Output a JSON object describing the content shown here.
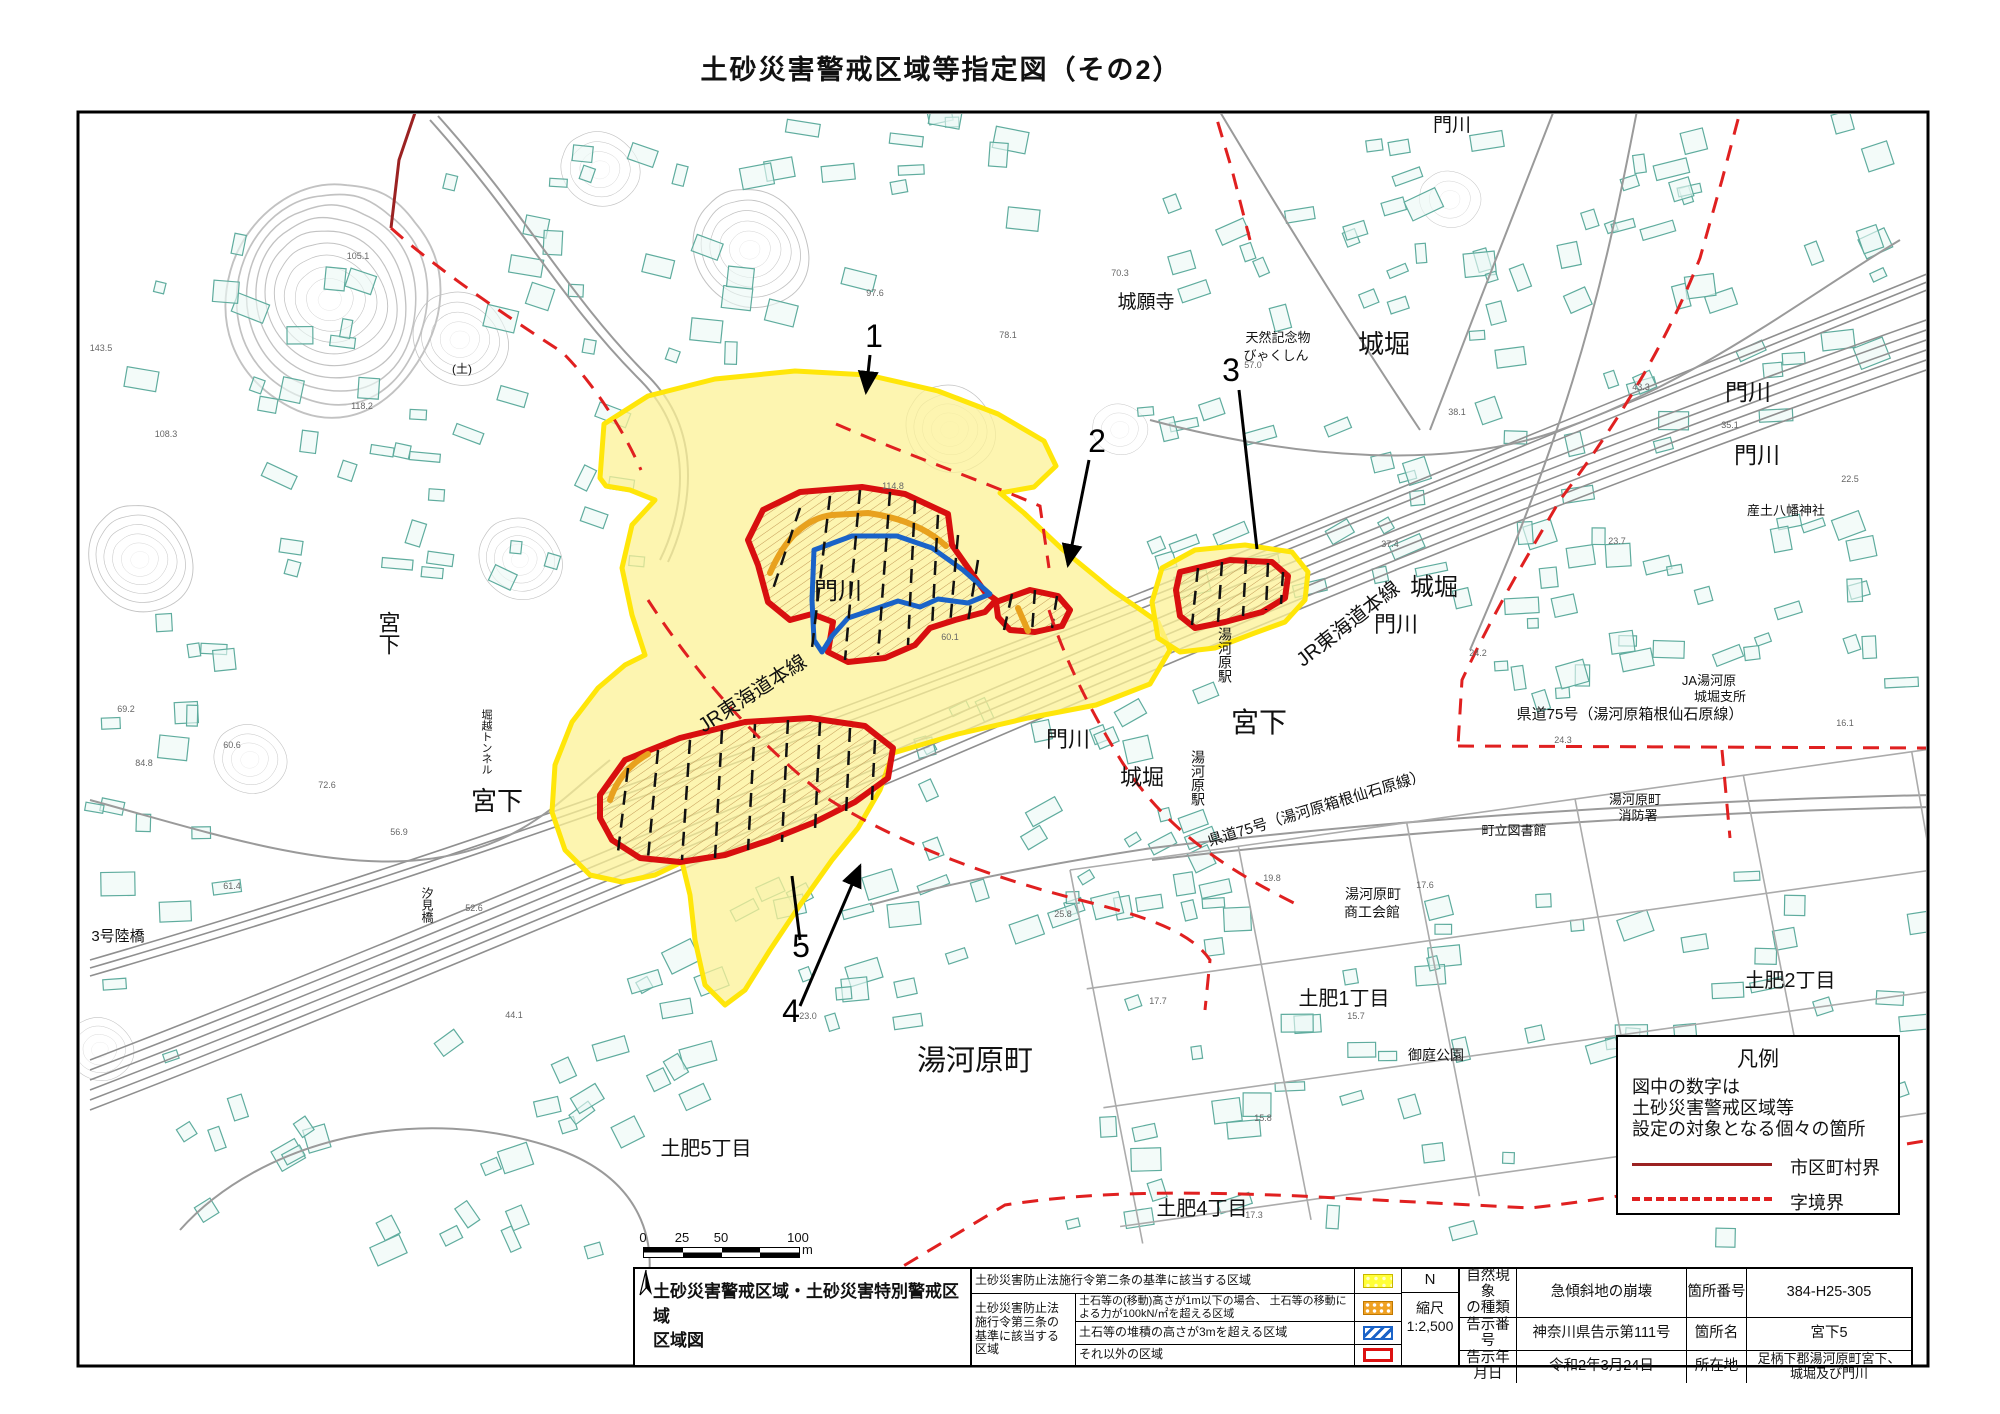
{
  "title": "土砂災害警戒区域等指定図（その2）",
  "map": {
    "place_labels": [
      {
        "t": "城堀",
        "x": 1464,
        "y": 70,
        "s": 19
      },
      {
        "t": "城堀",
        "x": 1524,
        "y": 108,
        "s": 19
      },
      {
        "t": "門川",
        "x": 1452,
        "y": 131,
        "s": 19
      },
      {
        "t": "門川",
        "x": 1748,
        "y": 400,
        "s": 23
      },
      {
        "t": "門川",
        "x": 1757,
        "y": 463,
        "s": 23
      },
      {
        "t": "城堀",
        "x": 1384,
        "y": 353,
        "s": 26
      },
      {
        "t": "城堀",
        "x": 1434,
        "y": 595,
        "s": 24
      },
      {
        "t": "城堀",
        "x": 1142,
        "y": 785,
        "s": 22
      },
      {
        "t": "門川",
        "x": 838,
        "y": 599,
        "s": 24
      },
      {
        "t": "門川",
        "x": 1068,
        "y": 747,
        "s": 22
      },
      {
        "t": "門川",
        "x": 1396,
        "y": 632,
        "s": 22
      },
      {
        "t": "城願寺",
        "x": 1146,
        "y": 308,
        "s": 19
      },
      {
        "t": "天然記念物",
        "x": 1278,
        "y": 342,
        "s": 13
      },
      {
        "t": "びゃくしん",
        "x": 1276,
        "y": 360,
        "s": 13
      },
      {
        "t": "宮下",
        "x": 1259,
        "y": 732,
        "s": 28
      },
      {
        "t": "宮下",
        "x": 497,
        "y": 810,
        "s": 26
      },
      {
        "t": "宮下",
        "x": 388,
        "y": 633,
        "s": 22,
        "v": 1
      },
      {
        "t": "湯河原町",
        "x": 975,
        "y": 1070,
        "s": 29
      },
      {
        "t": "土肥1丁目",
        "x": 1344,
        "y": 1005,
        "s": 20
      },
      {
        "t": "土肥2丁目",
        "x": 1790,
        "y": 987,
        "s": 20
      },
      {
        "t": "土肥5丁目",
        "x": 706,
        "y": 1155,
        "s": 20
      },
      {
        "t": "土肥4丁目",
        "x": 1202,
        "y": 1215,
        "s": 20
      },
      {
        "t": "御庭公園",
        "x": 1436,
        "y": 1060,
        "s": 14
      },
      {
        "t": "湯河原駅",
        "x": 1225,
        "y": 655,
        "s": 14,
        "v": 1
      },
      {
        "t": "湯河原駅",
        "x": 1198,
        "y": 778,
        "s": 14,
        "v": 1
      },
      {
        "t": "JR東海道本線",
        "x": 756,
        "y": 699,
        "s": 20,
        "r": -33
      },
      {
        "t": "JR東海道本線",
        "x": 1352,
        "y": 629,
        "s": 20,
        "r": -38
      },
      {
        "t": "県道75号（湯河原箱根仙石原線）",
        "x": 1318,
        "y": 813,
        "s": 15,
        "r": -17
      },
      {
        "t": "県道75号（湯河原箱根仙石原線）",
        "x": 1630,
        "y": 719,
        "s": 15
      },
      {
        "t": "JA湯河原",
        "x": 1709,
        "y": 685,
        "s": 13
      },
      {
        "t": "城堀支所",
        "x": 1720,
        "y": 701,
        "s": 13
      },
      {
        "t": "湯河原町",
        "x": 1635,
        "y": 804,
        "s": 13
      },
      {
        "t": "消防署",
        "x": 1638,
        "y": 820,
        "s": 13
      },
      {
        "t": "町立図書館",
        "x": 1514,
        "y": 835,
        "s": 13
      },
      {
        "t": "湯河原町",
        "x": 1373,
        "y": 899,
        "s": 14
      },
      {
        "t": "商工会館",
        "x": 1372,
        "y": 917,
        "s": 14
      },
      {
        "t": "産土八幡神社",
        "x": 1786,
        "y": 515,
        "s": 13
      },
      {
        "t": "3号陸橋",
        "x": 118,
        "y": 941,
        "s": 15
      },
      {
        "t": "汐見橋",
        "x": 427,
        "y": 905,
        "s": 12,
        "v": 1
      },
      {
        "t": "堀越トンネル",
        "x": 486,
        "y": 742,
        "s": 11,
        "v": 1
      },
      {
        "t": "(土)",
        "x": 462,
        "y": 373,
        "s": 12
      }
    ],
    "area_numbers": [
      {
        "n": "1",
        "x": 874,
        "y": 347,
        "x1": 870,
        "y1": 355,
        "x2": 866,
        "y2": 392,
        "a": 1
      },
      {
        "n": "2",
        "x": 1097,
        "y": 452,
        "x1": 1089,
        "y1": 460,
        "x2": 1068,
        "y2": 565,
        "a": 1
      },
      {
        "n": "3",
        "x": 1231,
        "y": 381,
        "x1": 1239,
        "y1": 390,
        "x2": 1257,
        "y2": 549,
        "a": 0
      },
      {
        "n": "4",
        "x": 791,
        "y": 1022,
        "x1": 800,
        "y1": 1006,
        "x2": 860,
        "y2": 866,
        "a": 1
      },
      {
        "n": "5",
        "x": 801,
        "y": 957,
        "x1": 800,
        "y1": 940,
        "x2": 792,
        "y2": 876,
        "a": 0
      }
    ],
    "spot_elevations": [
      {
        "v": "114.8",
        "x": 893,
        "y": 489
      },
      {
        "v": "60.1",
        "x": 950,
        "y": 640
      },
      {
        "v": "97.6",
        "x": 875,
        "y": 296
      },
      {
        "v": "78.1",
        "x": 1008,
        "y": 338
      },
      {
        "v": "70.3",
        "x": 1120,
        "y": 276
      },
      {
        "v": "57.0",
        "x": 1253,
        "y": 368
      },
      {
        "v": "38.1",
        "x": 1457,
        "y": 415
      },
      {
        "v": "43.3",
        "x": 1641,
        "y": 390
      },
      {
        "v": "35.1",
        "x": 1730,
        "y": 428
      },
      {
        "v": "22.5",
        "x": 1850,
        "y": 482
      },
      {
        "v": "23.7",
        "x": 1617,
        "y": 544
      },
      {
        "v": "37.4",
        "x": 1390,
        "y": 547
      },
      {
        "v": "24.2",
        "x": 1478,
        "y": 656
      },
      {
        "v": "24.3",
        "x": 1563,
        "y": 743
      },
      {
        "v": "16.1",
        "x": 1845,
        "y": 726
      },
      {
        "v": "19.8",
        "x": 1272,
        "y": 881
      },
      {
        "v": "17.6",
        "x": 1425,
        "y": 888
      },
      {
        "v": "25.8",
        "x": 1063,
        "y": 917
      },
      {
        "v": "23.0",
        "x": 808,
        "y": 1019
      },
      {
        "v": "44.1",
        "x": 514,
        "y": 1018
      },
      {
        "v": "17.7",
        "x": 1158,
        "y": 1004
      },
      {
        "v": "15.7",
        "x": 1356,
        "y": 1019
      },
      {
        "v": "15.8",
        "x": 1263,
        "y": 1121
      },
      {
        "v": "17.3",
        "x": 1254,
        "y": 1218
      },
      {
        "v": "84.8",
        "x": 144,
        "y": 766
      },
      {
        "v": "69.2",
        "x": 126,
        "y": 712
      },
      {
        "v": "60.6",
        "x": 232,
        "y": 748
      },
      {
        "v": "72.6",
        "x": 327,
        "y": 788
      },
      {
        "v": "56.9",
        "x": 399,
        "y": 835
      },
      {
        "v": "61.4",
        "x": 232,
        "y": 889
      },
      {
        "v": "52.6",
        "x": 474,
        "y": 911
      },
      {
        "v": "105.1",
        "x": 358,
        "y": 259
      },
      {
        "v": "143.5",
        "x": 101,
        "y": 351
      },
      {
        "v": "108.3",
        "x": 166,
        "y": 437
      },
      {
        "v": "118.2",
        "x": 362,
        "y": 409
      }
    ]
  },
  "legend": {
    "title": "凡例",
    "note": "図中の数字は\n土砂災害警戒区域等\n設定の対象となる個々の箇所",
    "solid_label": "市区町村界",
    "dashed_label": "字境界",
    "solid_color": "#9B2222",
    "dashed_color": "#E02020"
  },
  "scalebar": {
    "ticks": [
      "0",
      "25",
      "50",
      "100"
    ],
    "unit": "m"
  },
  "title_block": {
    "sheet_title": "土砂災害警戒区域・土砂災害特別警戒区域\n区域図",
    "law2_row": "土砂災害防止法施行令第二条の基準に該当する区域",
    "law3_label": "土砂災害防止法\n施行令第三条の\n基準に該当する\n区域",
    "law3_rows": [
      {
        "desc": "土石等の(移動)高さが1m以下の場合、\n土石等の移動による力が100kN/㎡を超える区域"
      },
      {
        "desc": "土石等の堆積の高さが3mを超える区域"
      },
      {
        "desc": "それ以外の区域"
      }
    ],
    "compass_n": "N",
    "scale_label": "縮尺",
    "scale_value": "1:2,500",
    "info": [
      {
        "label": "自然現象\nの種類",
        "value": "急傾斜地の崩壊",
        "label2": "箇所番号",
        "value2": "384-H25-305"
      },
      {
        "label": "告示番号",
        "value": "神奈川県告示第111号",
        "label2": "箇所名",
        "value2": "宮下5"
      },
      {
        "label": "告示年月日",
        "value": "令和2年3月24日",
        "label2": "所在地",
        "value2": "足柄下郡湯河原町宮下、\n城堀及び門川"
      }
    ]
  }
}
